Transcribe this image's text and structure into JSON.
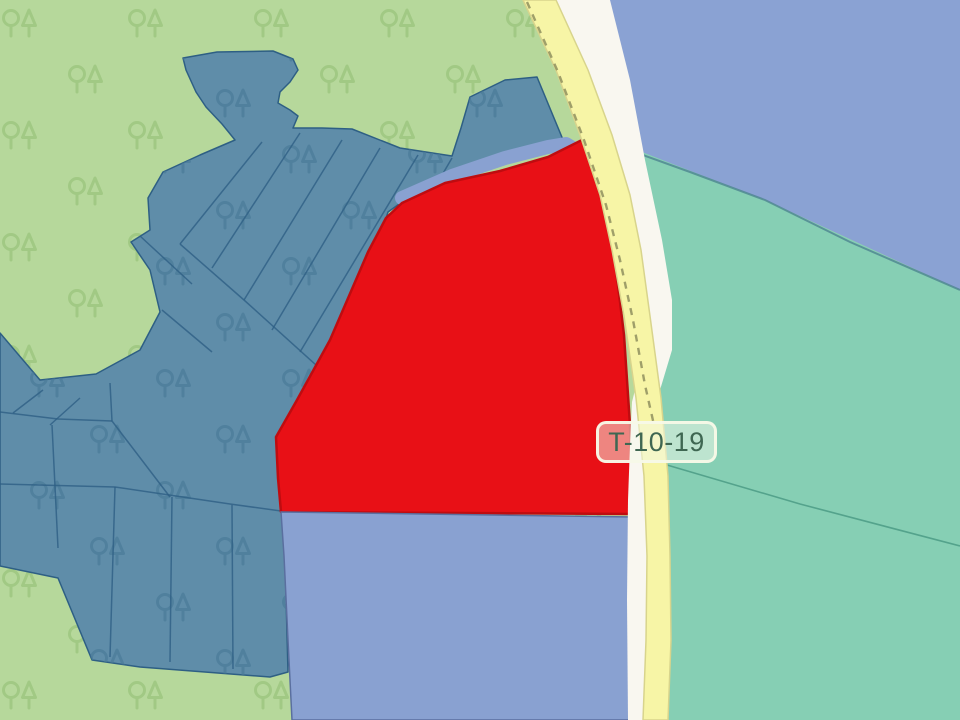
{
  "map": {
    "road_label": {
      "text": "T-10-19"
    },
    "colors": {
      "forest_green": "#b6d89b",
      "forest_tree_icon": "#9ac47c",
      "parcel_slate": "#5f8da9",
      "parcel_slate_border": "#2e5f84",
      "parcel_slate_tree_icon": "#497a99",
      "highlight_red": "#e81016",
      "highlight_red_border": "#bf0c10",
      "parcel_periwinkle": "#89a1d1",
      "parcel_periwinkle_border": "#5a6f9f",
      "water_periwinkle": "#8aa2d3",
      "water_teal_boundary": "#4c8390",
      "zone_teal": "#86cfb4",
      "zone_teal_border": "#4f9d87",
      "road_yellow": "#f7f5a6",
      "road_yellow_border": "#d8d48c",
      "road_white": "#f9f7f0",
      "road_dash": "#8f8f5e",
      "label_text": "#3f6752",
      "label_bg": "rgba(243,250,233,0.5)",
      "label_border": "rgba(248,250,232,0.95)"
    }
  }
}
